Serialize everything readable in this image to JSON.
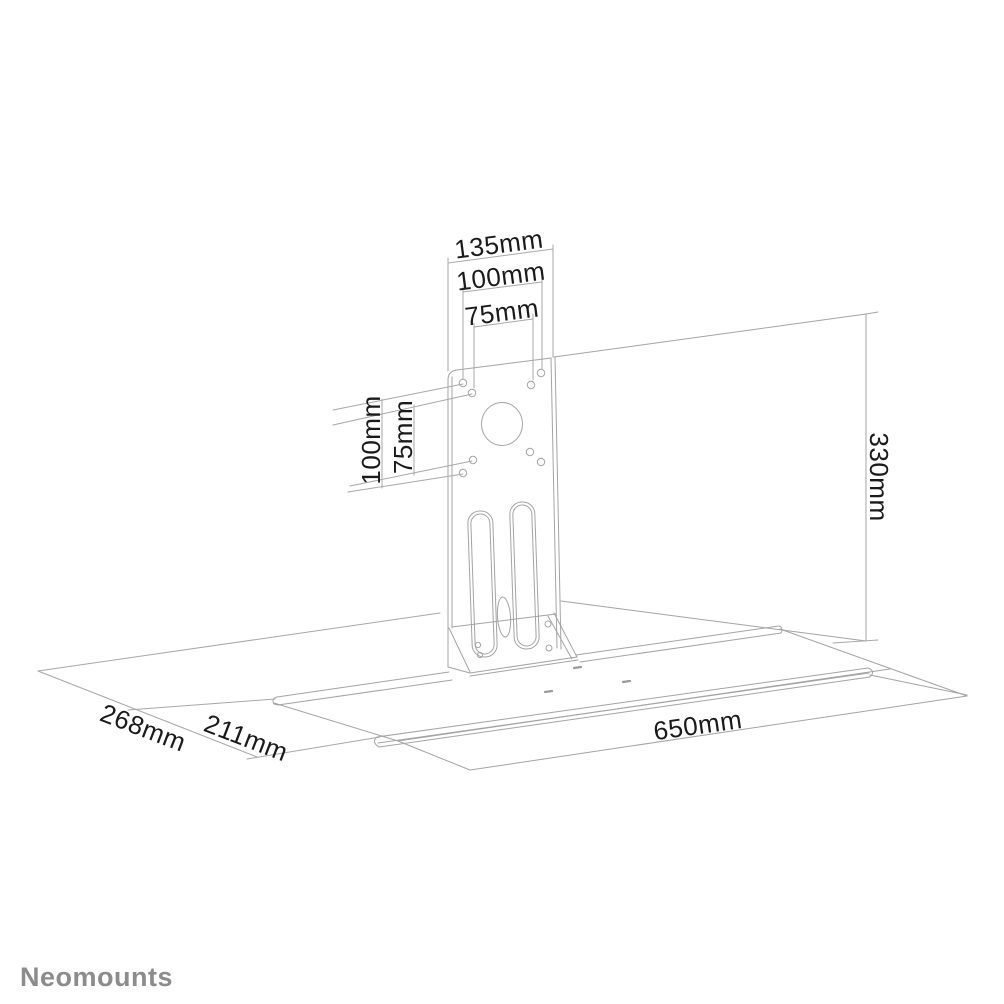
{
  "brand": "Neomounts",
  "colors": {
    "line": "#a4a4a4",
    "dimension_text": "#1a1a1a",
    "brand_text": "#8c8c8c",
    "background": "#ffffff"
  },
  "labels": {
    "bracket_width": "135mm",
    "vesa_horizontal_100": "100mm",
    "vesa_horizontal_75": "75mm",
    "vesa_vertical_100": "100mm",
    "vesa_vertical_75": "75mm",
    "panel_height": "330mm",
    "depth_total": "268mm",
    "depth_shelf": "211mm",
    "shelf_width": "650mm"
  }
}
